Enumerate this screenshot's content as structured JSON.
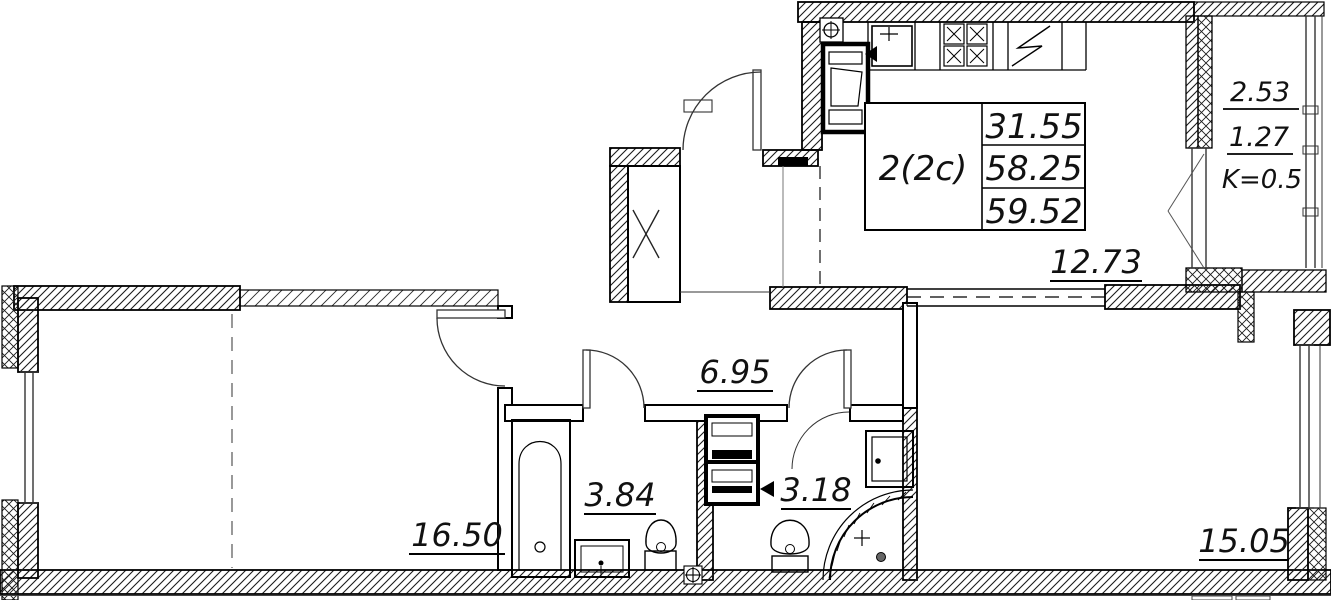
{
  "plan": {
    "unit": {
      "type": "2(2c)",
      "living_area": "31.55",
      "floor_area": "58.25",
      "total_area": "59.52"
    },
    "areas": {
      "kitchen_living": "12.73",
      "hallway": "6.95",
      "bathroom": "3.84",
      "shower_room": "3.18",
      "bedroom_left": "16.50",
      "bedroom_right": "15.05"
    },
    "balcony": {
      "full": "2.53",
      "reduced": "1.27",
      "coefficient": "K=0.5"
    }
  }
}
